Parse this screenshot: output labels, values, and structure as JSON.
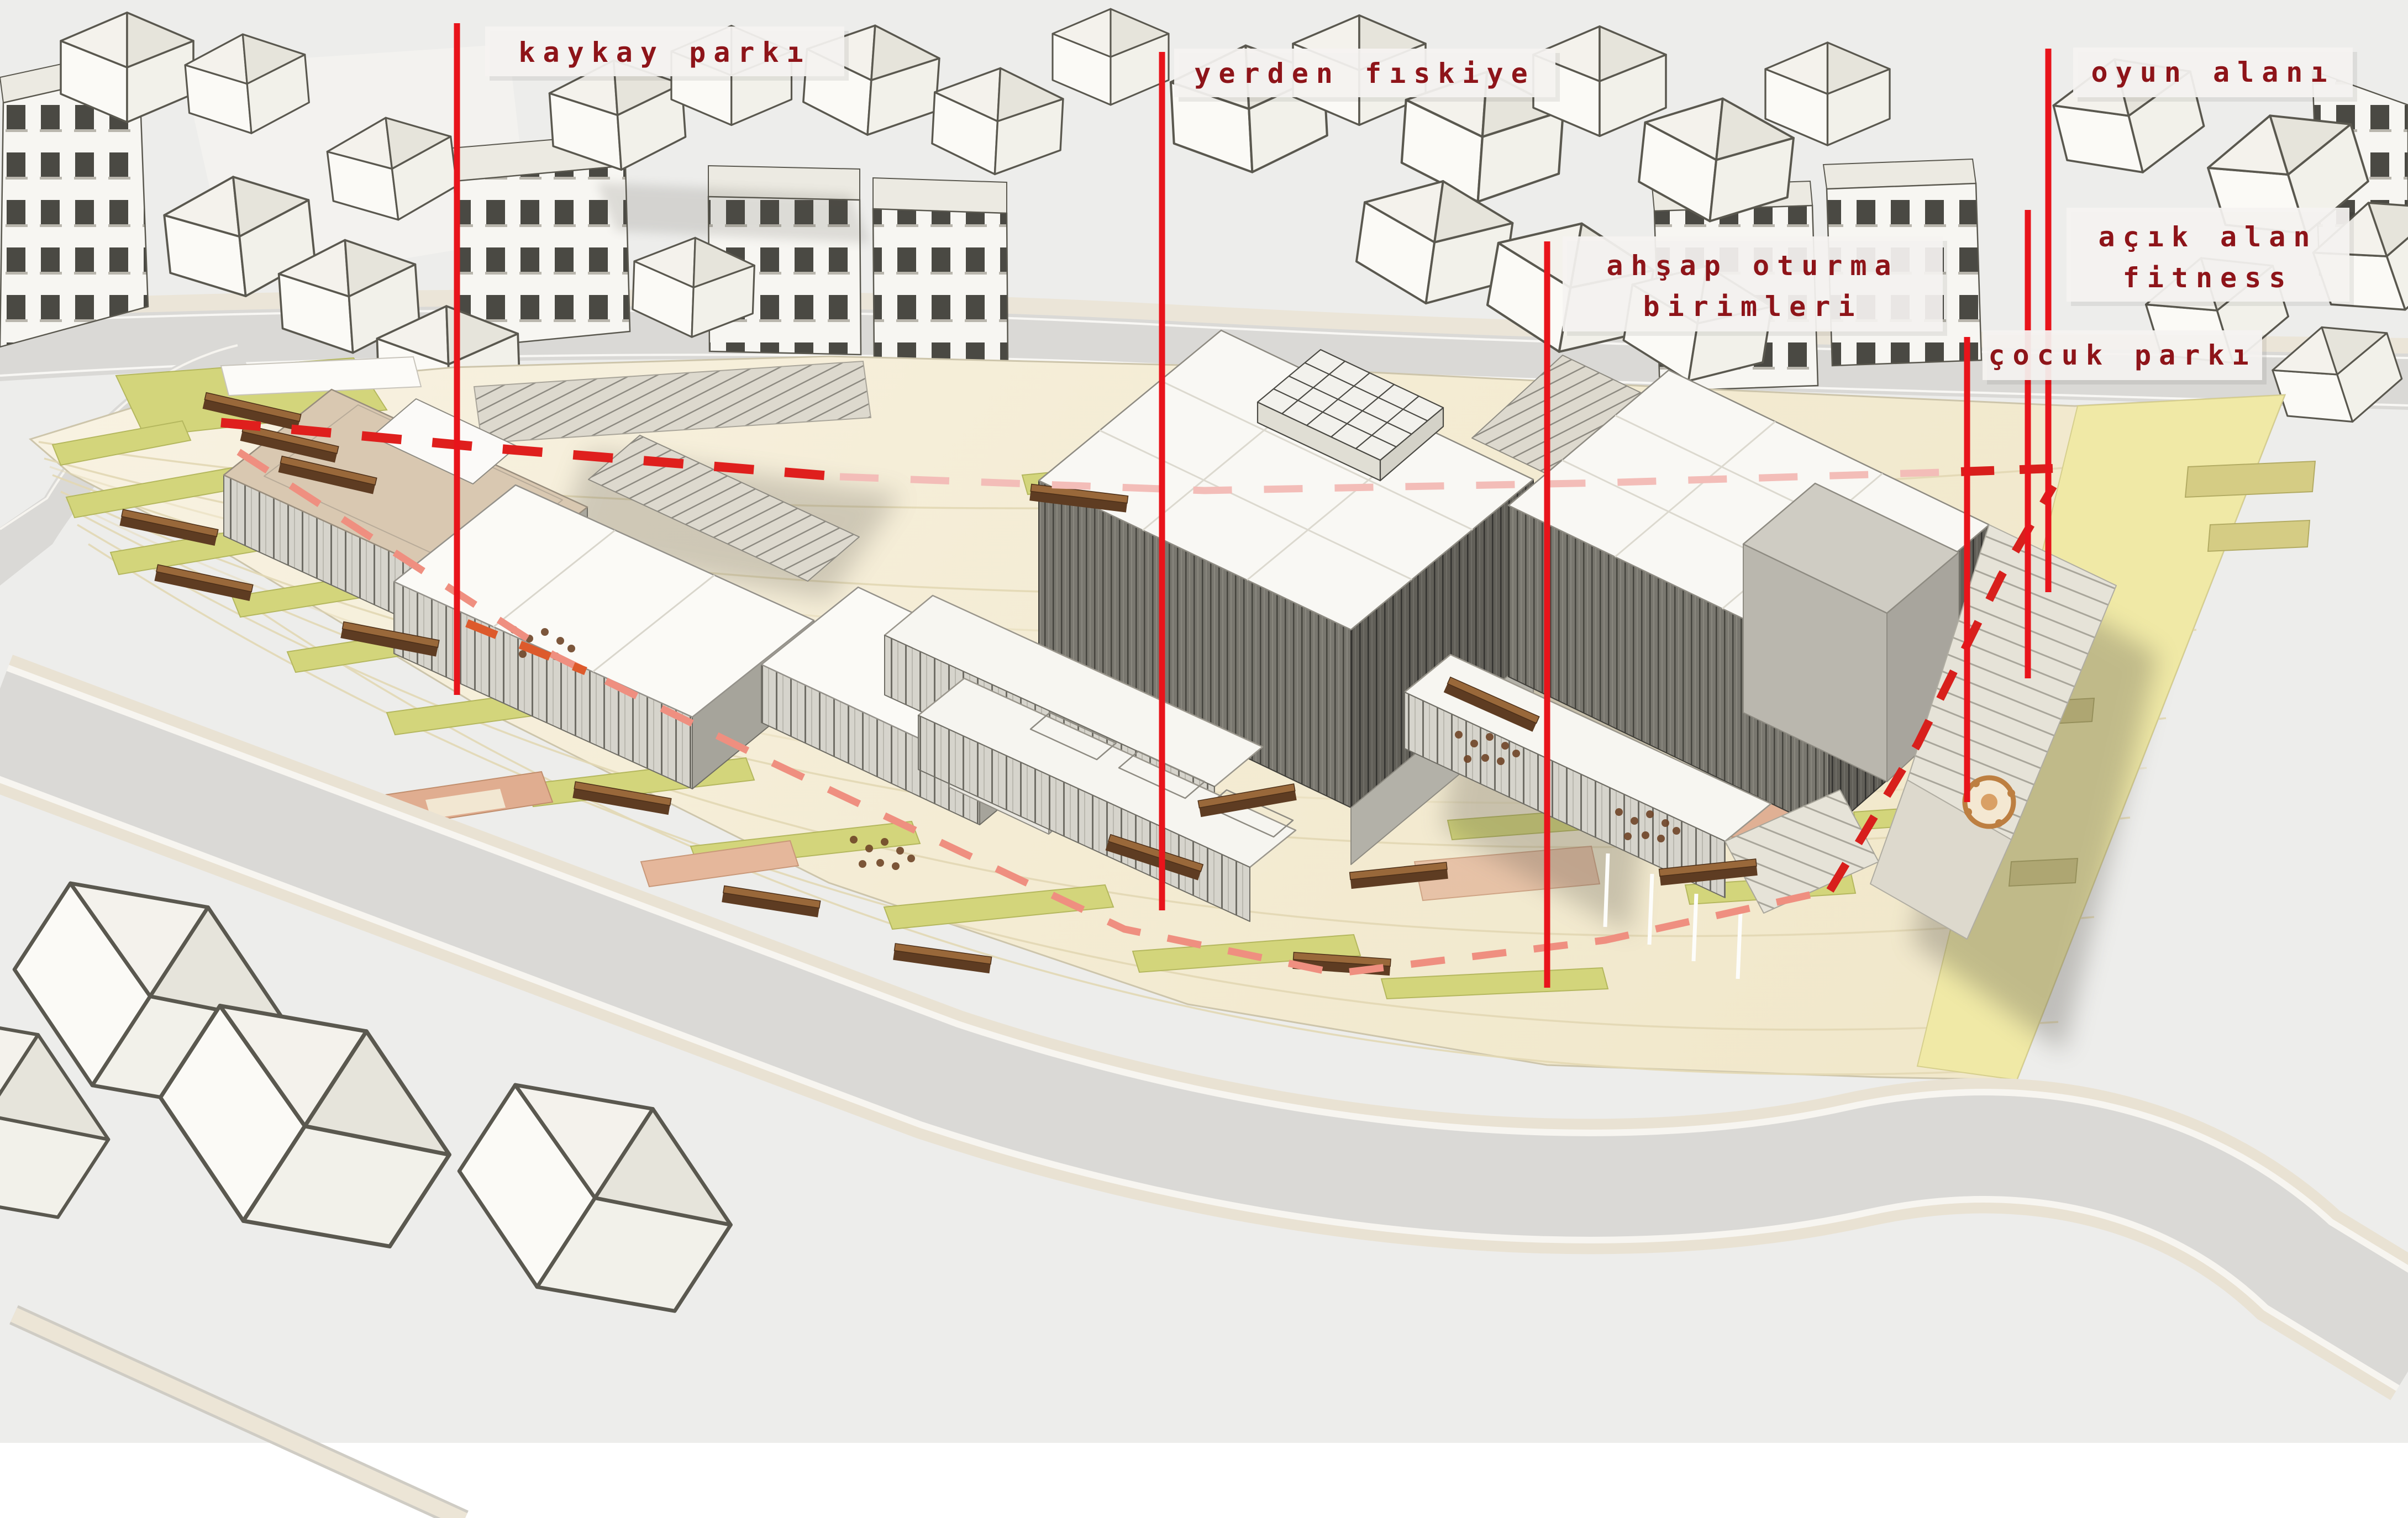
{
  "annotations": [
    {
      "id": "kaykay-parki",
      "text": "kaykay parkı"
    },
    {
      "id": "yerden-fiskiye",
      "text": "yerden fıskiye"
    },
    {
      "id": "ahsap-oturma-birimleri",
      "line1": "ahşap oturma",
      "line2": "birimleri"
    },
    {
      "id": "oyun-alani",
      "text": "oyun alanı"
    },
    {
      "id": "acik-alan-fitness",
      "line1": "açık alan",
      "line2": "fitness"
    },
    {
      "id": "cocuk-parki",
      "text": "çocuk parkı"
    }
  ],
  "colors": {
    "annotation_line": "#e8141b",
    "label_text": "#8e1419",
    "label_background": "#f5f3f1",
    "path_bold_red": "#df1f1d",
    "path_faded_pink": "#f3bdb8",
    "path_salmon": "#ef8f80",
    "plaza_paving": "#f4ecd6",
    "lawn_green": "#d3d57b",
    "activity_zone_yellow": "#f0e9a6",
    "road_gray": "#dad9d6",
    "bench_brown": "#5e3c22",
    "building_white": "#f9f8f4",
    "facade_dark": "#5f5d56"
  }
}
